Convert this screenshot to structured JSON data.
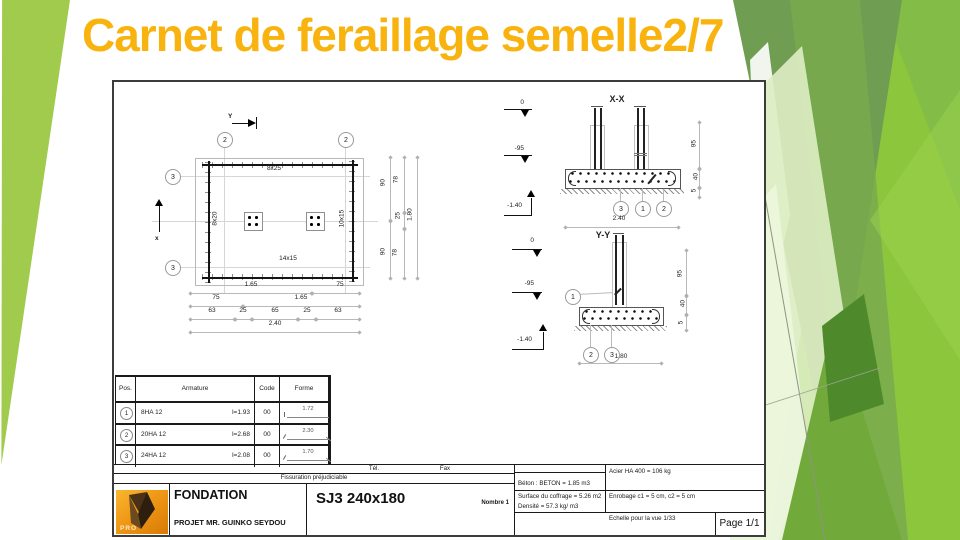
{
  "slide": {
    "title": "Carnet de feraillage semelle2/7",
    "accent": "#F8B30F",
    "lime": "#8CC63C",
    "olive": "#6F9D52"
  },
  "plan": {
    "axis_top": "Y",
    "axis_left": "x",
    "grid_top": [
      "2",
      "2"
    ],
    "grid_left": [
      "3",
      "3"
    ],
    "rebar_top": "8x25",
    "rebar_left": "8x20",
    "rebar_right": "10x15",
    "rebar_bottom": "14x15",
    "dim_rowA": [
      "1.65",
      "75"
    ],
    "dim_rowB": [
      "75",
      "1.65"
    ],
    "dim_rowC": [
      "63",
      "25",
      "65",
      "25",
      "63"
    ],
    "dim_total_h": "2.40",
    "dim_col1": [
      "90",
      "90"
    ],
    "dim_col2": [
      "78",
      "25",
      "78"
    ],
    "dim_total_v": "1.80"
  },
  "xx": {
    "title": "X-X",
    "lv0": "0",
    "lv1": "-95",
    "lv2": "-1.40",
    "b1": "3",
    "b2": "1",
    "b3": "2",
    "width": "2.40",
    "d1": "95",
    "d2": "40",
    "d3": "5"
  },
  "yy": {
    "title": "Y-Y",
    "lv0": "0",
    "lv1": "-95",
    "lv2": "-1.40",
    "b0": "1",
    "b1": "2",
    "b2": "3",
    "width": "1.80",
    "d1": "95",
    "d2": "40",
    "d3": "5"
  },
  "table": {
    "h": [
      "Pos.",
      "Armature",
      "Code",
      "Forme"
    ],
    "rows": [
      {
        "pos": "1",
        "bar": "8HA 12",
        "len": "l=1.93",
        "code": "00",
        "forme": "1.72"
      },
      {
        "pos": "2",
        "bar": "20HA 12",
        "len": "l=2.68",
        "code": "00",
        "forme": "2.30"
      },
      {
        "pos": "3",
        "bar": "24HA 12",
        "len": "l=2.08",
        "code": "00",
        "forme": "1.70"
      }
    ]
  },
  "tb": {
    "tel": "Tél.",
    "fax": "Fax",
    "fissuration": "Fissuration préjudiciable",
    "logo": "PRO",
    "name": "FONDATION",
    "project": "PROJET MR. GUINKO SEYDOU",
    "ref": "SJ3 240x180",
    "nombre": "Nombre 1",
    "beton": "Béton : BETON = 1.85 m3",
    "acier": "Acier HA 400 = 106 kg",
    "surface": "Surface du coffrage = 5.26 m2",
    "enrobage": "Enrobage  c1 = 5 cm,  c2 = 5 cm",
    "densite": "Densité = 57.3 kg/ m3",
    "echelle": "Echelle pour la vue 1/33",
    "page": "Page 1/1"
  }
}
